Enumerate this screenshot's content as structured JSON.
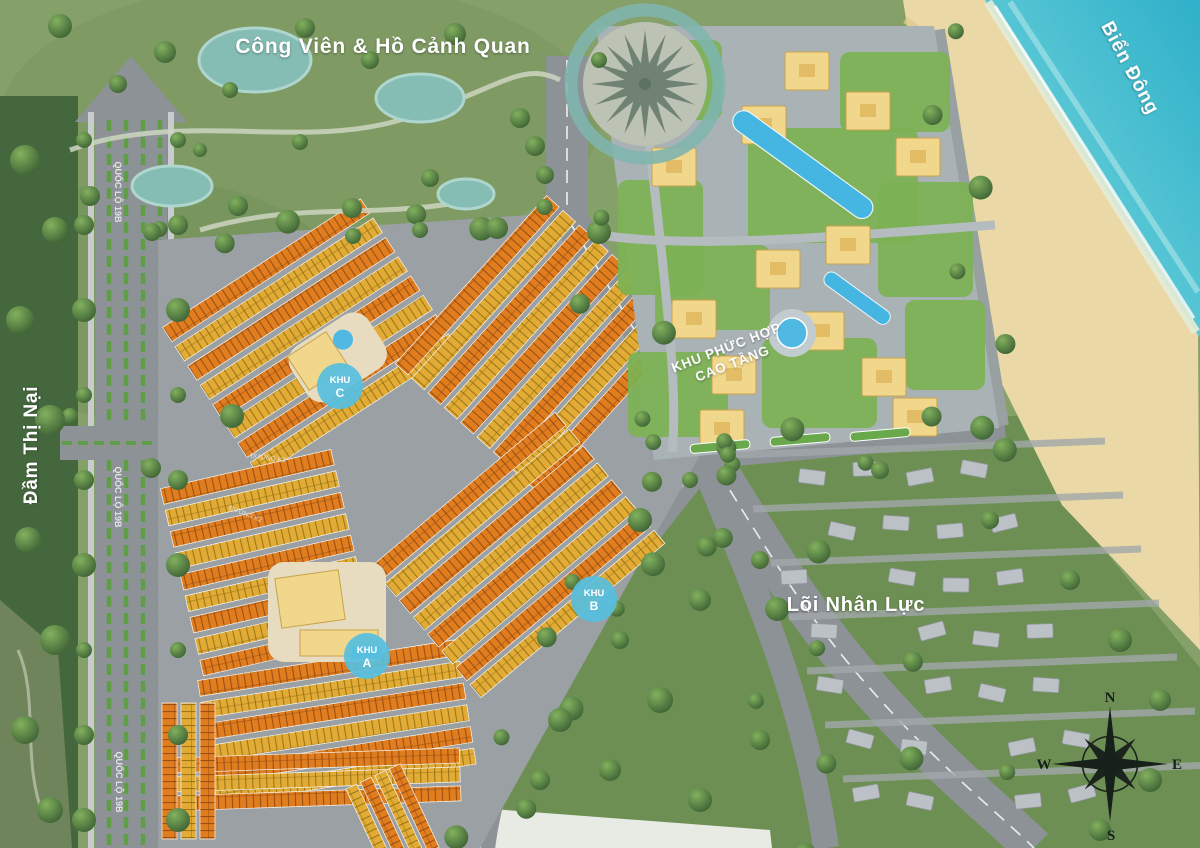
{
  "map": {
    "labels": {
      "park": "Công Viên & Hồ Cảnh Quan",
      "sea": "Biển Đông",
      "lagoon": "Đầm Thị Nại",
      "highway": "QUỐC LỘ 19B",
      "highrise_line1": "KHU PHỨC HỢP",
      "highrise_line2": "CAO TẦNG",
      "workforce": "Lõi Nhân Lực",
      "street_top": "ĐƯỜNG K3",
      "street_bottom": "ĐƯỜNG K2"
    },
    "zone_markers": [
      {
        "id": "khu-c",
        "word": "KHU",
        "letter": "C"
      },
      {
        "id": "khu-b",
        "word": "KHU",
        "letter": "B"
      },
      {
        "id": "khu-a",
        "word": "KHU",
        "letter": "A"
      }
    ],
    "compass": {
      "north": "N",
      "east": "E",
      "south": "S",
      "west": "W"
    },
    "colors": {
      "sea": "#3db6cd",
      "sand": "#ead9a6",
      "park_green": "#86a06a",
      "village_green": "#6d8f54",
      "road_gray": "#8d9296",
      "lot_orange": "#e07d1e",
      "lot_gold": "#e2ab35",
      "marker_blue": "#57c0df",
      "building_yellow": "#f1d78c",
      "pool_blue": "#4fb9e3"
    }
  }
}
